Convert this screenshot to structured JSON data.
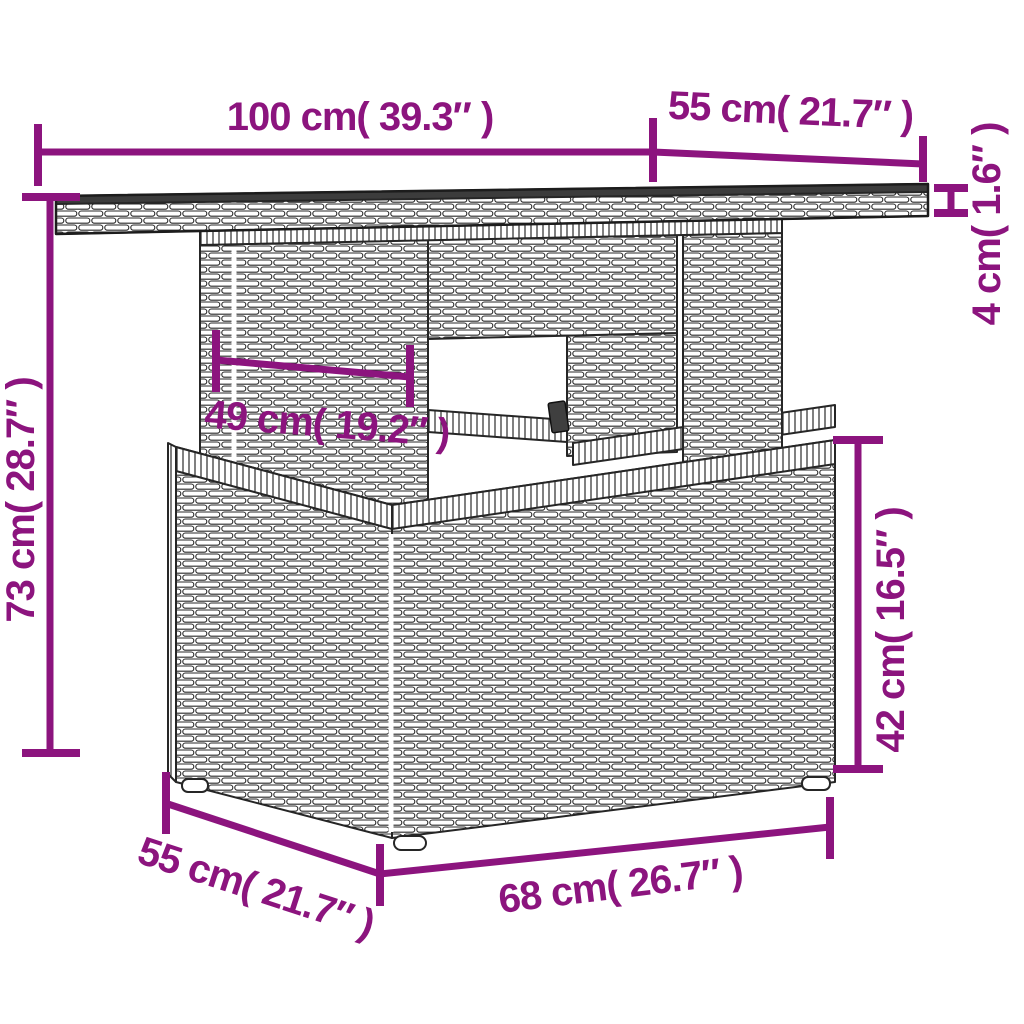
{
  "diagram": {
    "kind": "product-dimension-diagram",
    "subject": "poly-rattan garden table with pedestal base",
    "dimensions": {
      "top_width": "100 cm( 39.3″ )",
      "top_depth": "55 cm( 21.7″ )",
      "top_thickness": "4 cm( 1.6″ )",
      "overall_height": "73 cm( 28.7″ )",
      "pedestal_width": "49 cm( 19.2″ )",
      "base_height": "42 cm( 16.5″ )",
      "base_depth": "55 cm( 21.7″ )",
      "base_width": "68 cm( 26.7″ )"
    },
    "colors": {
      "dimension_annotation": "#8C147E",
      "line_art": "#262626",
      "tabletop_surface": "#3c3c3c",
      "background": "#ffffff"
    }
  }
}
